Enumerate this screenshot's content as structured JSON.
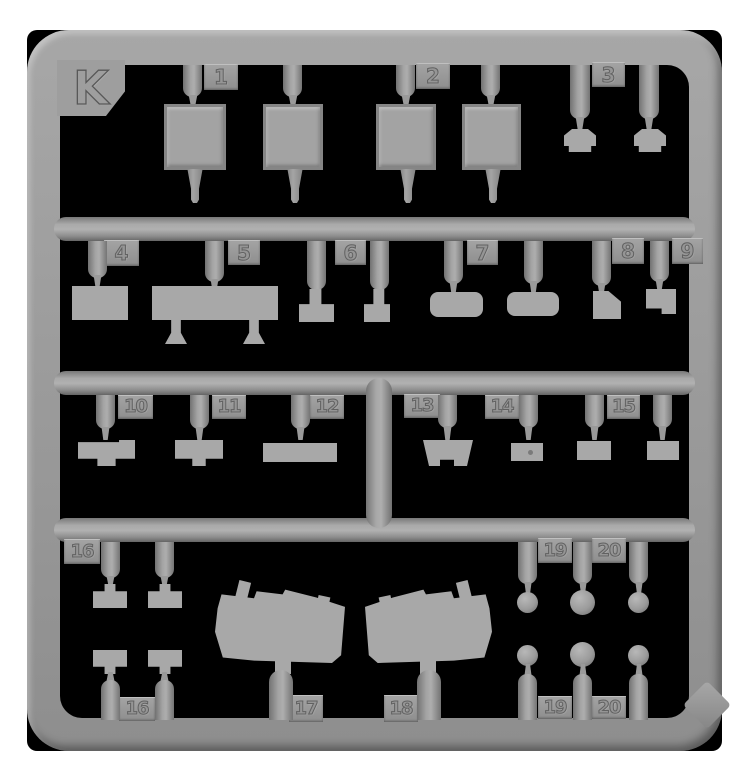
{
  "photo": {
    "subject": "Injection-molded plastic model kit sprue (runner frame) on black background",
    "sprue_letter": "K",
    "part_numbers_present": [
      "1",
      "2",
      "3",
      "4",
      "5",
      "6",
      "7",
      "8",
      "9",
      "10",
      "11",
      "12",
      "13",
      "14",
      "15",
      "16",
      "17",
      "18",
      "19",
      "20"
    ]
  },
  "colors": {
    "page_background": "#ffffff",
    "photo_background": "#000000",
    "plastic_mid": "#9b9b9b",
    "plastic_light": "#a8a8a8",
    "plastic_shadow": "#6e6e6e"
  },
  "tags": [
    "1",
    "2",
    "3",
    "4",
    "5",
    "6",
    "7",
    "8",
    "9",
    "10",
    "11",
    "12",
    "13",
    "14",
    "15",
    "16",
    "19",
    "20",
    "16",
    "17",
    "18",
    "19",
    "20"
  ]
}
